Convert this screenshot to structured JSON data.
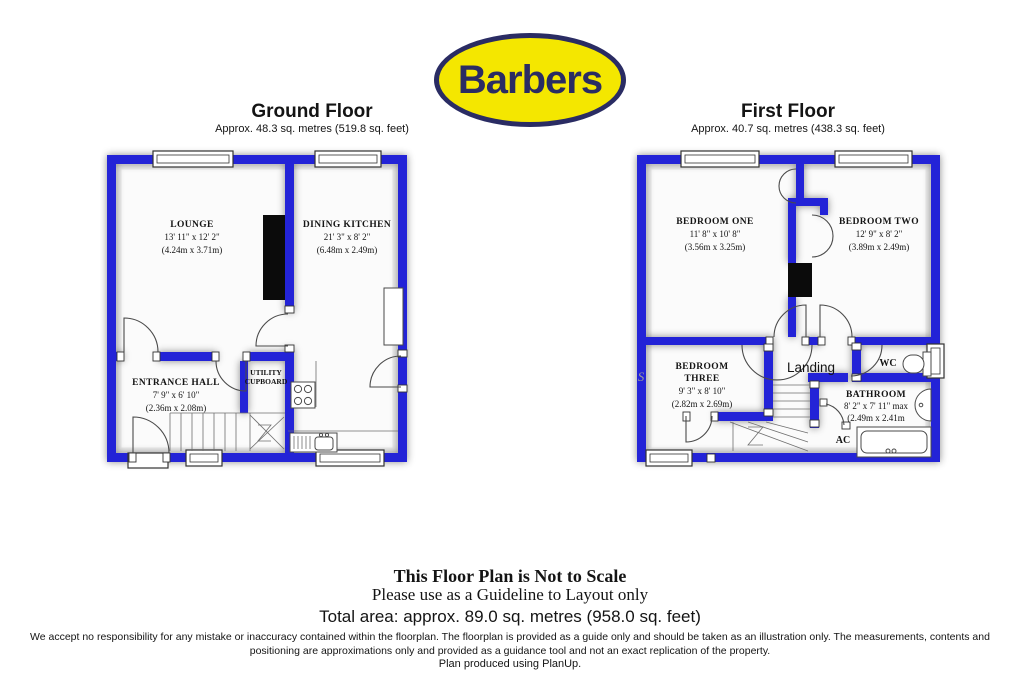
{
  "colors": {
    "wall": "#2323d7",
    "logo_bg": "#f4e700",
    "logo_ink": "#2a2c63",
    "paper": "#ffffff"
  },
  "logo": {
    "text": "Barbers"
  },
  "ground_floor": {
    "title": "Ground Floor",
    "subtitle": "Approx.  48.3 sq. metres (519.8 sq. feet)",
    "rooms": {
      "lounge": {
        "name": "LOUNGE",
        "imperial": "13' 11\" x 12' 2\"",
        "metric": "(4.24m x 3.71m)"
      },
      "dining_kitchen": {
        "name": "DINING KITCHEN",
        "imperial": "21' 3\" x 8' 2\"",
        "metric": "(6.48m x 2.49m)"
      },
      "entrance_hall": {
        "name": "ENTRANCE HALL",
        "imperial": "7' 9\" x 6' 10\"",
        "metric": "(2.36m x 2.08m)"
      },
      "utility": {
        "line1": "UTILITY",
        "line2": "CUPBOARD"
      }
    }
  },
  "first_floor": {
    "title": "First Floor",
    "subtitle": "Approx.  40.7 sq. metres (438.3 sq. feet)",
    "watermark": "S",
    "rooms": {
      "bedroom_one": {
        "name": "BEDROOM ONE",
        "imperial": "11' 8\" x 10' 8\"",
        "metric": "(3.56m x 3.25m)"
      },
      "bedroom_two": {
        "name": "BEDROOM TWO",
        "imperial": "12' 9\" x 8' 2\"",
        "metric": "(3.89m x 2.49m)"
      },
      "bedroom_three": {
        "name_line1": "BEDROOM",
        "name_line2": "THREE",
        "imperial": "9' 3\" x 8' 10\"",
        "metric": "(2.82m x 2.69m)"
      },
      "landing": {
        "name": "Landing"
      },
      "wc": {
        "name": "WC"
      },
      "bathroom": {
        "name": "BATHROOM",
        "imperial": "8' 2\" x 7' 11\" max",
        "metric": "(2.49m x 2.41m"
      },
      "ac": {
        "name": "AC"
      }
    }
  },
  "footer": {
    "not_to_scale": "This Floor Plan is Not to Scale",
    "guideline": "Please use as a Guideline to Layout only",
    "total_area": "Total area: approx.  89.0 sq. metres (958.0 sq. feet)",
    "disclaimer": "We accept no responsibility for any mistake or inaccuracy contained within the floorplan. The floorplan is provided as a guide only and should be taken as an illustration only. The measurements, contents and positioning are approximations only and provided as a guidance tool and not an exact replication of the property.",
    "produced": "Plan produced using PlanUp."
  }
}
